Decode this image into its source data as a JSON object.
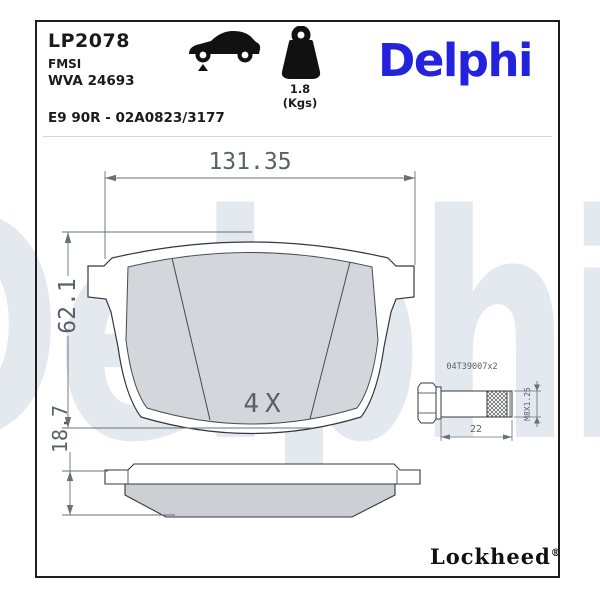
{
  "header": {
    "part_number": "LP2078",
    "fmsi_label": "FMSI",
    "wva_number": "WVA 24693",
    "homologation": "E9 90R - 02A0823/3177",
    "weight_value": "1.8 (Kgs)",
    "brand": "Delphi"
  },
  "icons": {
    "car": "car-front-axle-icon",
    "weight": "weight-icon"
  },
  "watermark_text": "Delphi",
  "front_view": {
    "width_dim": "131.35",
    "height_dim": "62.1",
    "quantity": "4X"
  },
  "side_view": {
    "thickness_dim": "18.7"
  },
  "bolt": {
    "part_label": "04T39007x2",
    "length_dim": "22",
    "thread_spec": "M8X1.25"
  },
  "footer": {
    "brand": "Lockheed",
    "registered_mark": "®"
  },
  "colors": {
    "brand_blue": "#2323DE",
    "watermark": "#E4E9EF",
    "friction_gray": "#D3D6DA",
    "line_dark": "#34383E",
    "dim_gray": "#6B7076"
  }
}
